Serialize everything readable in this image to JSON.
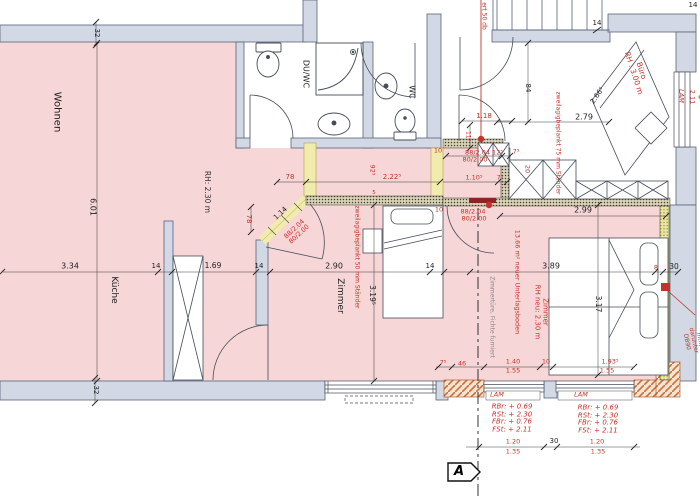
{
  "plan_title": "apartment floor plan with renovation annotations",
  "colors": {
    "room_pink": "#f6d6d7",
    "wall_gray": "#d2d9e4",
    "highlight_yellow": "#f1ecae",
    "annotation_red": "#c4332b",
    "line_dark": "#3a4048"
  },
  "section_marker": {
    "label": "A"
  },
  "labels": [
    {
      "id": "room-wohnen",
      "text": "Wohnen",
      "x": 57,
      "y": 112,
      "rot": 90,
      "color": "#222",
      "size": 10
    },
    {
      "id": "room-kueche",
      "text": "Küche",
      "x": 113,
      "y": 290,
      "rot": 90,
      "color": "#222",
      "size": 9
    },
    {
      "id": "room-duwc",
      "text": "DU/WC",
      "x": 305,
      "y": 74,
      "rot": 90,
      "color": "#222",
      "size": 8
    },
    {
      "id": "room-wc",
      "text": "WC",
      "x": 411,
      "y": 92,
      "rot": 90,
      "color": "#222",
      "size": 8
    },
    {
      "id": "room-zimmer-mitte",
      "text": "Zimmer",
      "x": 339,
      "y": 296,
      "rot": 90,
      "color": "#222",
      "size": 9
    },
    {
      "id": "note-rh230",
      "text": "RH: 2.30 m",
      "x": 207,
      "y": 192,
      "rot": 90,
      "color": "#333",
      "size": 7.5
    },
    {
      "id": "dim-601",
      "text": "6.01",
      "x": 92,
      "y": 207,
      "rot": 90,
      "color": "#222",
      "size": 8
    },
    {
      "id": "dim-334",
      "text": "3.34",
      "x": 70,
      "y": 267,
      "rot": 0,
      "color": "#222",
      "size": 8
    },
    {
      "id": "dim-14a",
      "text": "14",
      "x": 156,
      "y": 267,
      "rot": 0,
      "color": "#222",
      "size": 7
    },
    {
      "id": "dim-169",
      "text": "1.69",
      "x": 213,
      "y": 266,
      "rot": 0,
      "color": "#222",
      "size": 7.5
    },
    {
      "id": "dim-14b",
      "text": "14",
      "x": 259,
      "y": 267,
      "rot": 0,
      "color": "#222",
      "size": 7
    },
    {
      "id": "dim-290",
      "text": "2.90",
      "x": 334,
      "y": 267,
      "rot": 0,
      "color": "#222",
      "size": 8
    },
    {
      "id": "dim-14c",
      "text": "14",
      "x": 430,
      "y": 267,
      "rot": 0,
      "color": "#222",
      "size": 7
    },
    {
      "id": "dim-3195",
      "text": "3.19⁵",
      "x": 372,
      "y": 295,
      "rot": 90,
      "color": "#222",
      "size": 7.5
    },
    {
      "id": "dim-32top",
      "text": "32",
      "x": 96,
      "y": 33,
      "rot": 90,
      "color": "#222",
      "size": 7
    },
    {
      "id": "dim-32bot",
      "text": "32",
      "x": 95,
      "y": 390,
      "rot": 90,
      "color": "#222",
      "size": 7
    },
    {
      "id": "dim-78top",
      "text": "78",
      "x": 290,
      "y": 178,
      "rot": 0,
      "color": "#c4332b",
      "size": 7
    },
    {
      "id": "dim-2225",
      "text": "2.22⁵",
      "x": 392,
      "y": 178,
      "rot": 0,
      "color": "#c4332b",
      "size": 7
    },
    {
      "id": "dim-925",
      "text": "92⁵",
      "x": 372,
      "y": 170,
      "rot": 90,
      "color": "#c4332b",
      "size": 6.5
    },
    {
      "id": "dim-78left",
      "text": "78",
      "x": 248,
      "y": 219,
      "rot": 90,
      "color": "#c4332b",
      "size": 7
    },
    {
      "id": "dim-114",
      "text": "1.14",
      "x": 281,
      "y": 214,
      "rot": -43,
      "color": "#222",
      "size": 7
    },
    {
      "id": "door-label-diag",
      "text": "88/2.04\n80/2.00",
      "x": 297,
      "y": 232,
      "rot": -43,
      "color": "#c4332b",
      "size": 6.5
    },
    {
      "id": "note-zweilagig-50",
      "text": "zweilagigbeplankt 50 mm Ständer",
      "x": 356,
      "y": 257,
      "rot": 90,
      "color": "#c4332b",
      "size": 6
    },
    {
      "id": "dim-10a",
      "text": "10",
      "x": 438,
      "y": 151,
      "rot": 0,
      "color": "#c4332b",
      "size": 6.5
    },
    {
      "id": "door-label-1a",
      "text": "88/2.04  12⁵",
      "x": 484,
      "y": 153,
      "rot": 0,
      "color": "#c4332b",
      "size": 6.5
    },
    {
      "id": "door-label-1b",
      "text": "80/2.00",
      "x": 475,
      "y": 160,
      "rot": 0,
      "color": "#c4332b",
      "size": 6.5
    },
    {
      "id": "dim-75a",
      "text": "7⁵",
      "x": 516,
      "y": 152,
      "rot": 0,
      "color": "#c4332b",
      "size": 6.5
    },
    {
      "id": "dim-1105",
      "text": "1.10⁵",
      "x": 474,
      "y": 178,
      "rot": 0,
      "color": "#c4332b",
      "size": 6.5
    },
    {
      "id": "dim-75b",
      "text": "7⁵",
      "x": 500,
      "y": 178,
      "rot": 0,
      "color": "#c4332b",
      "size": 6.5
    },
    {
      "id": "dim-20",
      "text": "20",
      "x": 527,
      "y": 169,
      "rot": 90,
      "color": "#c4332b",
      "size": 6.5
    },
    {
      "id": "dim-10b",
      "text": "10",
      "x": 439,
      "y": 210,
      "rot": 0,
      "color": "#c4332b",
      "size": 6.5
    },
    {
      "id": "door-label-2a",
      "text": "88/2.04",
      "x": 473,
      "y": 212,
      "rot": 0,
      "color": "#c4332b",
      "size": 6.5
    },
    {
      "id": "door-label-2b",
      "text": "80/2.00",
      "x": 474,
      "y": 219,
      "rot": 0,
      "color": "#c4332b",
      "size": 6.5
    },
    {
      "id": "dim-118",
      "text": "1.18",
      "x": 484,
      "y": 117,
      "rot": 0,
      "color": "#c4332b",
      "size": 7
    },
    {
      "id": "dim-115",
      "text": "11⁵",
      "x": 467,
      "y": 136,
      "rot": 90,
      "color": "#c4332b",
      "size": 6
    },
    {
      "id": "note-50db",
      "text": "ert 50 db",
      "x": 483,
      "y": 16,
      "rot": 90,
      "color": "#c4332b",
      "size": 6
    },
    {
      "id": "note-zweilagig-75",
      "text": "zweilagigbeplankt 75 mm Ständer",
      "x": 557,
      "y": 143,
      "rot": 90,
      "color": "#c4332b",
      "size": 6
    },
    {
      "id": "dim-84",
      "text": "84",
      "x": 527,
      "y": 88,
      "rot": 90,
      "color": "#222",
      "size": 7
    },
    {
      "id": "dim-279",
      "text": "2.79",
      "x": 584,
      "y": 118,
      "rot": 0,
      "color": "#222",
      "size": 8
    },
    {
      "id": "dim-2665",
      "text": "2.66⁵",
      "x": 598,
      "y": 96,
      "rot": -55,
      "color": "#222",
      "size": 7
    },
    {
      "id": "room-buero",
      "text": "Büro\nRH : 3.00 m",
      "x": 637,
      "y": 72,
      "rot": 72,
      "color": "#c4332b",
      "size": 7.5
    },
    {
      "id": "dim-14stair",
      "text": "14",
      "x": 597,
      "y": 24,
      "rot": 0,
      "color": "#222",
      "size": 7
    },
    {
      "id": "dim-14tr",
      "text": "14",
      "x": 693,
      "y": 6,
      "rot": 0,
      "color": "#222",
      "size": 7
    },
    {
      "id": "lam-right",
      "text": "LAM",
      "x": 681,
      "y": 96,
      "rot": 90,
      "color": "#c4332b",
      "size": 6.5,
      "i": true
    },
    {
      "id": "note-fbr-right",
      "text": "FBr. + 2.11",
      "x": 699,
      "y": 97,
      "rot": 90,
      "color": "#c4332b",
      "size": 6.5
    },
    {
      "id": "dim-299",
      "text": "2.99",
      "x": 583,
      "y": 211,
      "rot": 0,
      "color": "#222",
      "size": 8
    },
    {
      "id": "note-unterlagsboden",
      "text": "13.66 m² neuer Unterlagsboden",
      "x": 517,
      "y": 282,
      "rot": 90,
      "color": "#c4332b",
      "size": 6.5
    },
    {
      "id": "room-zimmer-rh",
      "text": "Zimmer\nRH neu: 2.30 m",
      "x": 541,
      "y": 312,
      "rot": 90,
      "color": "#c4332b",
      "size": 7
    },
    {
      "id": "dim-389",
      "text": "3.89",
      "x": 551,
      "y": 267,
      "rot": 0,
      "color": "#222",
      "size": 8
    },
    {
      "id": "dim-317",
      "text": "3.17",
      "x": 598,
      "y": 304,
      "rot": 90,
      "color": "#222",
      "size": 7.5
    },
    {
      "id": "dim-8",
      "text": "8",
      "x": 656,
      "y": 268,
      "rot": 0,
      "color": "#c4332b",
      "size": 6.5
    },
    {
      "id": "dim-30a",
      "text": "30",
      "x": 674,
      "y": 267,
      "rot": 0,
      "color": "#222",
      "size": 7.5
    },
    {
      "id": "note-xps",
      "text": "XPS 80 mm, darunter DB90",
      "x": 696,
      "y": 340,
      "rot": 78,
      "color": "#c4332b",
      "size": 6
    },
    {
      "id": "note-zimmertuere",
      "text": "Zimmertüre, Fichte furniert",
      "x": 491,
      "y": 317,
      "rot": 90,
      "color": "#8a8a8a",
      "size": 6
    },
    {
      "id": "dim-75c",
      "text": "7⁵",
      "x": 443,
      "y": 363,
      "rot": 0,
      "color": "#c4332b",
      "size": 6.5
    },
    {
      "id": "dim-46",
      "text": "46",
      "x": 462,
      "y": 364,
      "rot": 0,
      "color": "#c4332b",
      "size": 6.5
    },
    {
      "id": "dim-140",
      "text": "1.40",
      "x": 513,
      "y": 362,
      "rot": 0,
      "color": "#c4332b",
      "size": 6.5
    },
    {
      "id": "dim-155a",
      "text": "1.55",
      "x": 513,
      "y": 371,
      "rot": 0,
      "color": "#c4332b",
      "size": 6.5
    },
    {
      "id": "dim-10c",
      "text": "10",
      "x": 546,
      "y": 362,
      "rot": 0,
      "color": "#c4332b",
      "size": 6.5
    },
    {
      "id": "dim-1935",
      "text": "1.93⁵",
      "x": 610,
      "y": 362,
      "rot": 0,
      "color": "#c4332b",
      "size": 6.5
    },
    {
      "id": "dim-155b",
      "text": "1.55",
      "x": 607,
      "y": 371,
      "rot": 0,
      "color": "#c4332b",
      "size": 6.5
    },
    {
      "id": "lam-1",
      "text": "LAM",
      "x": 497,
      "y": 395,
      "rot": 0,
      "color": "#c4332b",
      "size": 6.5,
      "i": true
    },
    {
      "id": "lam-2",
      "text": "LAM",
      "x": 581,
      "y": 395,
      "rot": 0,
      "color": "#c4332b",
      "size": 6.5,
      "i": true
    },
    {
      "id": "levels-1",
      "text": "RBr: + 0.69\nRSt: + 2.30\nFBr: + 0.76\nFSt: + 2.11",
      "x": 512,
      "y": 419,
      "rot": 0,
      "color": "#c4332b",
      "size": 7,
      "i": true
    },
    {
      "id": "levels-2",
      "text": "RBr: + 0.69\nRSt: + 2.30\nFBr: + 0.76\nFSt: + 2.11",
      "x": 598,
      "y": 420,
      "rot": 0,
      "color": "#c4332b",
      "size": 7,
      "i": true
    },
    {
      "id": "dim-120a",
      "text": "1.20",
      "x": 513,
      "y": 442,
      "rot": 0,
      "color": "#c4332b",
      "size": 6.5
    },
    {
      "id": "dim-135a",
      "text": "1.35",
      "x": 513,
      "y": 452,
      "rot": 0,
      "color": "#c4332b",
      "size": 6.5
    },
    {
      "id": "dim-30b",
      "text": "30",
      "x": 554,
      "y": 442,
      "rot": 0,
      "color": "#222",
      "size": 7
    },
    {
      "id": "dim-120b",
      "text": "1.20",
      "x": 597,
      "y": 442,
      "rot": 0,
      "color": "#c4332b",
      "size": 6.5
    },
    {
      "id": "dim-135b",
      "text": "1.35",
      "x": 598,
      "y": 452,
      "rot": 0,
      "color": "#c4332b",
      "size": 6.5
    },
    {
      "id": "dim-5",
      "text": "5",
      "x": 374,
      "y": 193,
      "rot": 0,
      "color": "#c4332b",
      "size": 5.5
    },
    {
      "id": "section-marker-a",
      "text": "A",
      "x": 459,
      "y": 472,
      "rot": 0,
      "color": "#000",
      "size": 13,
      "b": true,
      "i": true
    }
  ]
}
